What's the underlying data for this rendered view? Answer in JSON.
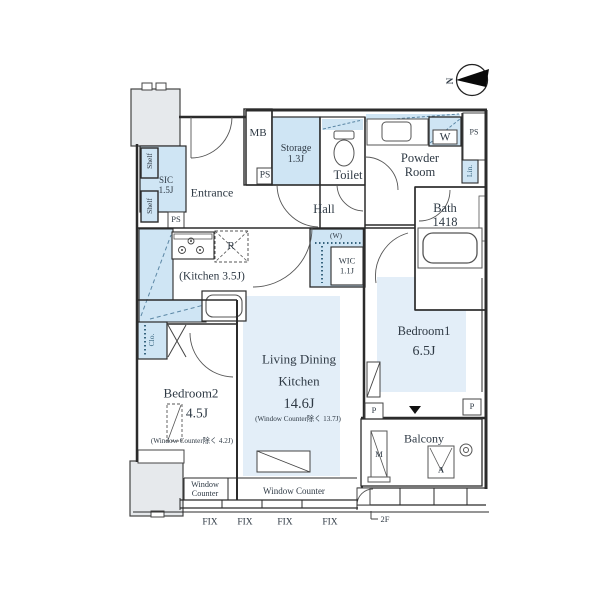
{
  "colors": {
    "cabinet_fill": "#cfe5f4",
    "floor_fill": "#e3eef8",
    "wall": "#2b2b2b",
    "column_fill": "#e6e9ec",
    "thin_line": "#555555",
    "dash_line": "#5b87a5",
    "text": "#2f3a45"
  },
  "compass": {
    "north": "N"
  },
  "entry": {
    "entrance": "Entrance",
    "sic": {
      "line1": "SIC",
      "line2": "1.5J"
    },
    "shelf": "Shelf",
    "ps": "PS",
    "mb": "MB"
  },
  "water": {
    "storage": {
      "line1": "Storage",
      "line2": "1.3J"
    },
    "toilet": "Toilet",
    "powder": {
      "line1": "Powder",
      "line2": "Room"
    },
    "washer": "W",
    "linen": "Lin.",
    "bath": {
      "line1": "Bath",
      "line2": "1418"
    }
  },
  "hall": {
    "label": "Hall"
  },
  "kitchen": {
    "label": "(Kitchen 3.5J)",
    "fridge": "R"
  },
  "wic": {
    "w": "(W)",
    "line1": "WIC",
    "line2": "1.1J"
  },
  "closet": {
    "label": "Clo."
  },
  "bedroom2": {
    "name": "Bedroom2",
    "size": "4.5J",
    "note": "(Window Counter除く 4.2J)"
  },
  "ldk": {
    "line1": "Living Dining",
    "line2": "Kitchen",
    "size": "14.6J",
    "note": "(Window Counter除く 13.7J)"
  },
  "bedroom1": {
    "name": "Bedroom1",
    "size": "6.5J"
  },
  "balcony": {
    "label": "Balcony",
    "meter": "M",
    "aircon": "A",
    "pillar": "P"
  },
  "south": {
    "window_counter_small": {
      "line1": "Window",
      "line2": "Counter"
    },
    "window_counter": "Window Counter",
    "fix": "FIX",
    "floor": "2F"
  }
}
